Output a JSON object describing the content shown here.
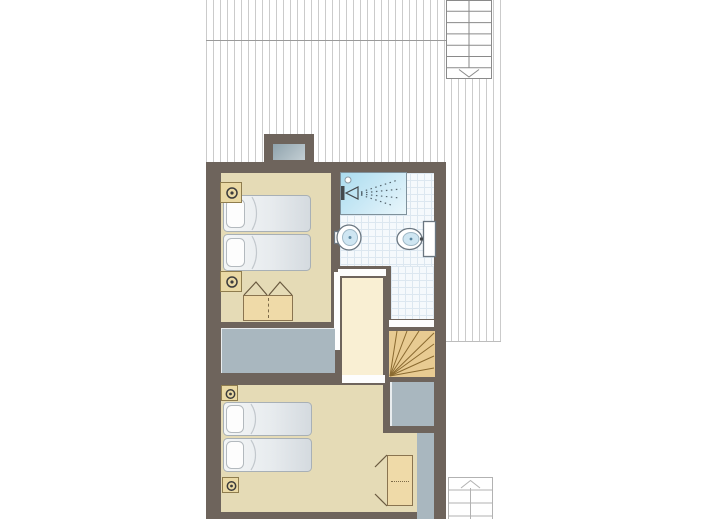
{
  "document": {
    "type": "floor-plan",
    "visible_text": [],
    "description": "Upper-floor plan of a house: two bedrooms, bathroom, landing with winder stair, hatched roof/terrace areas and two exterior stair symbols"
  },
  "colors": {
    "wall": "#6e645c",
    "floor-bedroom": "#e5dbb6",
    "floor-hall": "#f9efd3",
    "void-gray": "#a9b7bf",
    "wood": "#efdaa8",
    "wood-stair": "#e8cb92",
    "wood-line": "#8a6a30",
    "tile-bg": "#f5f9fc",
    "tile-line": "#dce7f0",
    "hatch-line": "#cbcbcb",
    "stair-line": "#8a8a8a",
    "nightstand": "#ead9a4",
    "basin-blue": "#cfe6f2"
  },
  "rooms": [
    {
      "id": "bedroom-top",
      "furniture": [
        "double-bed",
        "nightstand-with-lamp",
        "nightstand-with-lamp",
        "wardrobe-double-doors"
      ]
    },
    {
      "id": "bathroom",
      "furniture": [
        "shower",
        "washbasin",
        "toilet"
      ]
    },
    {
      "id": "hall-landing",
      "furniture": []
    },
    {
      "id": "bedroom-bottom",
      "furniture": [
        "double-bed",
        "nightstand-with-lamp",
        "nightstand-with-lamp",
        "wardrobe-double-doors"
      ]
    }
  ],
  "stairs": [
    {
      "id": "stairs-exterior-top-right",
      "direction": "down",
      "steps": 7
    },
    {
      "id": "stairs-interior-winder",
      "type": "quarter-turn"
    },
    {
      "id": "stairs-exterior-bottom-right",
      "direction": "up"
    }
  ],
  "voids": [
    "chimney-flue",
    "landing-void-strip",
    "void-top-right-bedroom2",
    "void-right-strip"
  ]
}
